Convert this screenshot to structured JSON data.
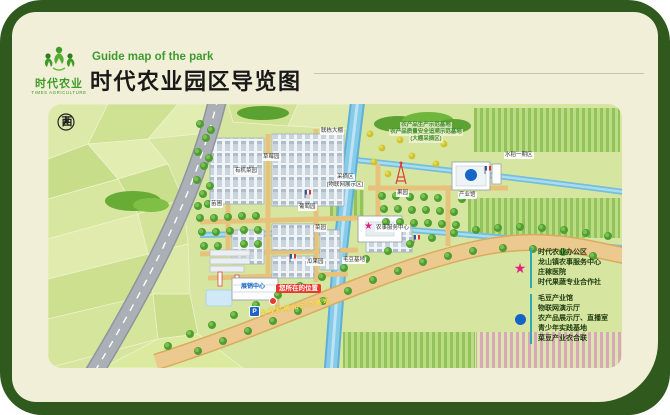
{
  "header": {
    "logo": {
      "name": "时代农业",
      "sub": "TIMES AGRICULTURE"
    },
    "subtitle_en": "Guide map of the park",
    "title": "时代农业园区导览图"
  },
  "map": {
    "compass": "西",
    "you_are_here": "您所在的位置",
    "parking": "P",
    "road_label": "全程机械化示范基地",
    "notes": {
      "line1": "农产品生产示范基地",
      "line2": "农产品质量安全追溯示范基地",
      "line3": "(大棚采摘区)"
    },
    "labels": {
      "strawberry": "草莓园",
      "organic": "有机菜园",
      "multispan": "联栋大棚",
      "nursery": "苗圃",
      "grape": "葡萄园",
      "picking": "采摘区",
      "picking_sub": "[物联网展示区]",
      "vegetable": "菜园",
      "melon": "瓜果园",
      "soybean": "毛豆基地",
      "orchard": "果园",
      "rice": "水稻一期区",
      "hall": "产业馆",
      "service": "农事服务中心",
      "expo": "展销中心"
    }
  },
  "legend": {
    "star": {
      "color": "#e0217f",
      "items": [
        "时代农业办公区",
        "龙山镇农事服务中心",
        "庄稼医院",
        "时代果蔬专业合作社"
      ]
    },
    "dot": {
      "color": "#1663c7",
      "items": [
        "毛豆产业馆",
        "物联网演示厅",
        "农产品展示厅、直播室",
        "青少年实践基地",
        "菜豆产业农合联"
      ]
    }
  },
  "colors": {
    "frame_green": "#305a1d",
    "card_cream": "#f2efd8",
    "map_base": "#d6e6a0",
    "river_blue": "#74bede",
    "road_tan": "#ecc98f",
    "legend_divider": "#2fa8b8",
    "you_here_red": "#e8392f",
    "title_green": "#3f9b2f"
  }
}
